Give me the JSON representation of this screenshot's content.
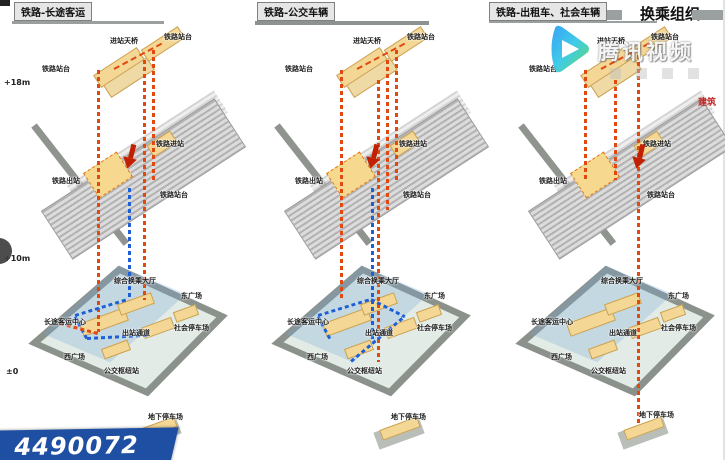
{
  "header": {
    "transfer_title": "换乘组织",
    "note_red": "建筑"
  },
  "elevations": [
    {
      "label": "+18m"
    },
    {
      "label": "+10m"
    },
    {
      "label": "±0"
    }
  ],
  "watermark": {
    "brand": "腾讯视频",
    "logo_icon": "play-icon",
    "number": "4490072"
  },
  "colors": {
    "flow_orange": "#e0490f",
    "flow_blue": "#1f5fd6",
    "arrow_red": "#c22000",
    "slab_yellow": "#f4d795",
    "ribbon_blue": "#1e4fa3"
  },
  "panels": [
    {
      "title": "铁路-长途客运",
      "upper": {
        "platform_left": "铁路站台",
        "bridge": "进站天桥",
        "platform_right": "铁路站台"
      },
      "track": {
        "exit": "铁路出站",
        "enter": "铁路进站",
        "platform": "铁路站台"
      },
      "ground": {
        "hall": "综合换乘大厅",
        "east_square": "东广场",
        "longdist_center": "长途客运中心",
        "exit_corridor": "出站通道",
        "social_parking": "社会停车场",
        "west_square": "西广场",
        "bus_hub": "公交枢纽站",
        "underground_parking": "地下停车场"
      }
    },
    {
      "title": "铁路-公交车辆",
      "upper": {
        "platform_left": "铁路站台",
        "bridge": "进站天桥",
        "platform_right": "铁路站台"
      },
      "track": {
        "exit": "铁路出站",
        "enter": "铁路进站",
        "platform": "铁路站台"
      },
      "ground": {
        "hall": "综合换乘大厅",
        "east_square": "东广场",
        "longdist_center": "长途客运中心",
        "exit_corridor": "出站通道",
        "social_parking": "社会停车场",
        "west_square": "西广场",
        "bus_hub": "公交枢纽站",
        "underground_parking": "地下停车场"
      }
    },
    {
      "title": "铁路-出租车、社会车辆",
      "upper": {
        "platform_left": "铁路站台",
        "bridge": "进站天桥",
        "platform_right": "铁路站台"
      },
      "track": {
        "exit": "铁路出站",
        "enter": "铁路进站",
        "platform": "铁路站台"
      },
      "ground": {
        "hall": "综合换乘大厅",
        "east_square": "东广场",
        "longdist_center": "长途客运中心",
        "exit_corridor": "出站通道",
        "social_parking": "社会停车场",
        "west_square": "西广场",
        "bus_hub": "公交枢纽站",
        "underground_parking": "地下停车场"
      }
    }
  ]
}
